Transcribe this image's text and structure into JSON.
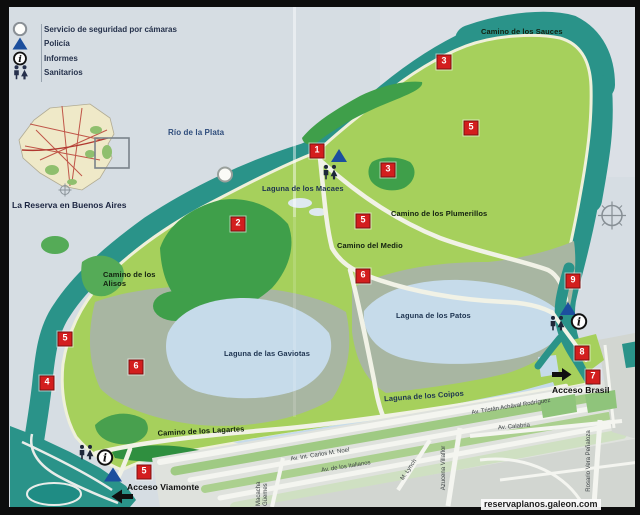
{
  "legend": {
    "items": [
      {
        "icon": "camera-circle-icon",
        "label": "Servicio de seguridad por cámaras"
      },
      {
        "icon": "police-triangle-icon",
        "label": "Policía"
      },
      {
        "icon": "info-icon",
        "label": "Informes"
      },
      {
        "icon": "restroom-icon",
        "label": "Sanitarios"
      }
    ]
  },
  "inset": {
    "caption": "La Reserva en Buenos Aires"
  },
  "map": {
    "river_label": "Río de la Plata",
    "trails": {
      "sauces": "Camino de los Sauces",
      "plumerillos": "Camino de los Plumerillos",
      "medio": "Camino del Medio",
      "alisos": "Camino de los Alisos",
      "lagartes": "Camino de los Lagartes"
    },
    "lagoons": {
      "macaes": "Laguna de los Macaes",
      "gaviotas": "Laguna de las Gaviotas",
      "patos": "Laguna de los Patos",
      "coipos": "Laguna de los Coipos"
    },
    "accesses": {
      "brasil": "Acceso Brasil",
      "viamonte": "Acceso Viamonte"
    },
    "markers": [
      {
        "n": "1"
      },
      {
        "n": "3"
      },
      {
        "n": "5"
      },
      {
        "n": "3"
      },
      {
        "n": "5"
      },
      {
        "n": "2"
      },
      {
        "n": "6"
      },
      {
        "n": "5"
      },
      {
        "n": "4"
      },
      {
        "n": "6"
      },
      {
        "n": "5"
      },
      {
        "n": "9"
      },
      {
        "n": "8"
      },
      {
        "n": "7"
      }
    ]
  },
  "streets": {
    "rodriguez": "Av. Tristán Achával Rodríguez",
    "calabria": "Av. Calabria",
    "noel": "Av. Int. Carlos M. Noel",
    "italianos": "Av. de los Italianos",
    "lynch": "M. Lynch",
    "villaflor": "Azucena Villaflor",
    "penaloza": "Rosario Vera Peñaloza",
    "guemes": "Macacha Güemes"
  },
  "watermark": "reservaplanos.galeon.com",
  "colors": {
    "water_band": "#2a9389",
    "land": "#a6d05c",
    "forest": "#3f9f4a",
    "marsh": "#a8b6a2",
    "lagoon": "#c6dbea",
    "river": "#d6dde3",
    "marker_red": "#d31e1e",
    "police_blue": "#1c4f9e"
  }
}
